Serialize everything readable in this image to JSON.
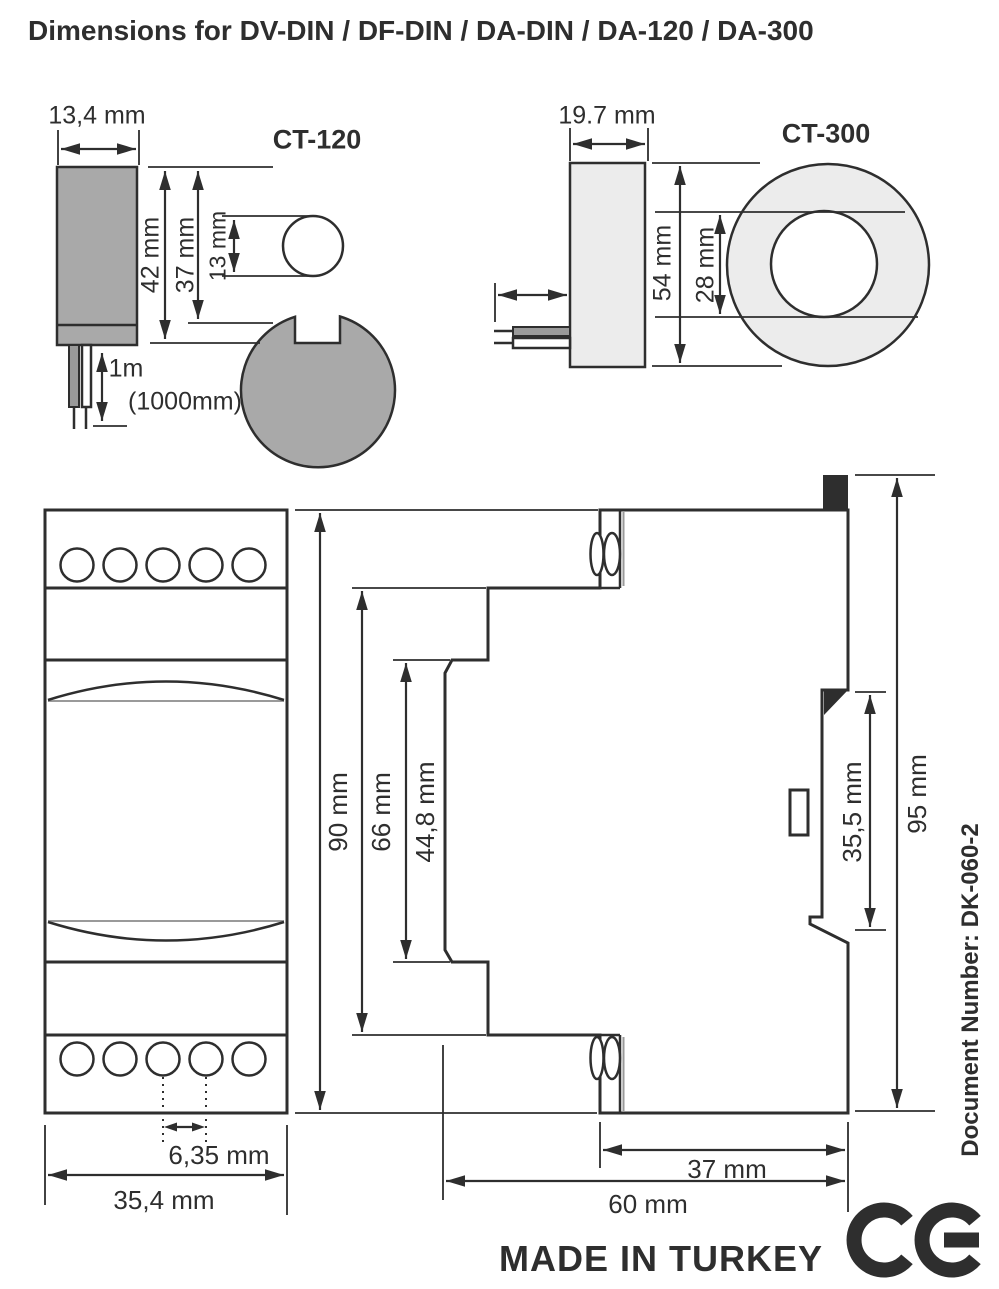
{
  "title": "Dimensions for DV-DIN / DF-DIN / DA-DIN / DA-120 / DA-300",
  "ct120": {
    "label": "CT-120",
    "dims": {
      "body_width": "13,4 mm",
      "overall_height": "42 mm",
      "ring_diameter": "37 mm",
      "hole_diameter": "13 mm",
      "cable_length": "1m",
      "cable_length_mm": "(1000mm)"
    }
  },
  "ct300": {
    "label": "CT-300",
    "dims": {
      "body_width": "19.7 mm",
      "ring_diameter": "54 mm",
      "hole_diameter": "28 mm"
    }
  },
  "din_module": {
    "front": {
      "height": "90 mm",
      "width": "35,4 mm",
      "terminal_pitch": "6,35 mm"
    },
    "side": {
      "body_height": "66 mm",
      "window_height": "44,8 mm",
      "rail_recess_height": "35,5 mm",
      "overall_height": "95 mm",
      "rear_depth": "37 mm",
      "overall_depth": "60 mm"
    }
  },
  "footer": {
    "made_in": "MADE IN TURKEY",
    "document_number": "Document Number: DK-060-2",
    "ce_mark": "CE"
  },
  "colors": {
    "line": "#2e2e2e",
    "ct120_fill": "#a9a9a9",
    "ct300_fill": "#ececec",
    "shade": "#9a9a9a"
  }
}
